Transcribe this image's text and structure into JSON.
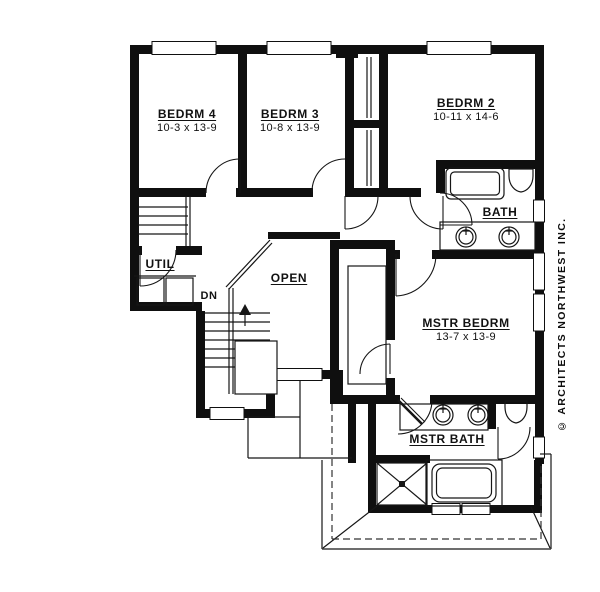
{
  "drawing": {
    "type": "second-floor-plan",
    "ink_color": "#0f0f0f",
    "paper_color": "#ffffff"
  },
  "rooms": [
    {
      "name": "BEDRM 4",
      "dims": "10-3 x 13-9"
    },
    {
      "name": "BEDRM 3",
      "dims": "10-8 x 13-9"
    },
    {
      "name": "BEDRM 2",
      "dims": "10-11 x 14-6"
    },
    {
      "name": "BATH",
      "dims": ""
    },
    {
      "name": "UTIL",
      "dims": ""
    },
    {
      "name": "OPEN",
      "dims": ""
    },
    {
      "name": "MSTR BEDRM",
      "dims": "13-7 x 13-9"
    },
    {
      "name": "MSTR BATH",
      "dims": ""
    }
  ],
  "stair": {
    "down_label": "DN"
  },
  "copyright": "© ARCHITECTS NORTHWEST INC."
}
